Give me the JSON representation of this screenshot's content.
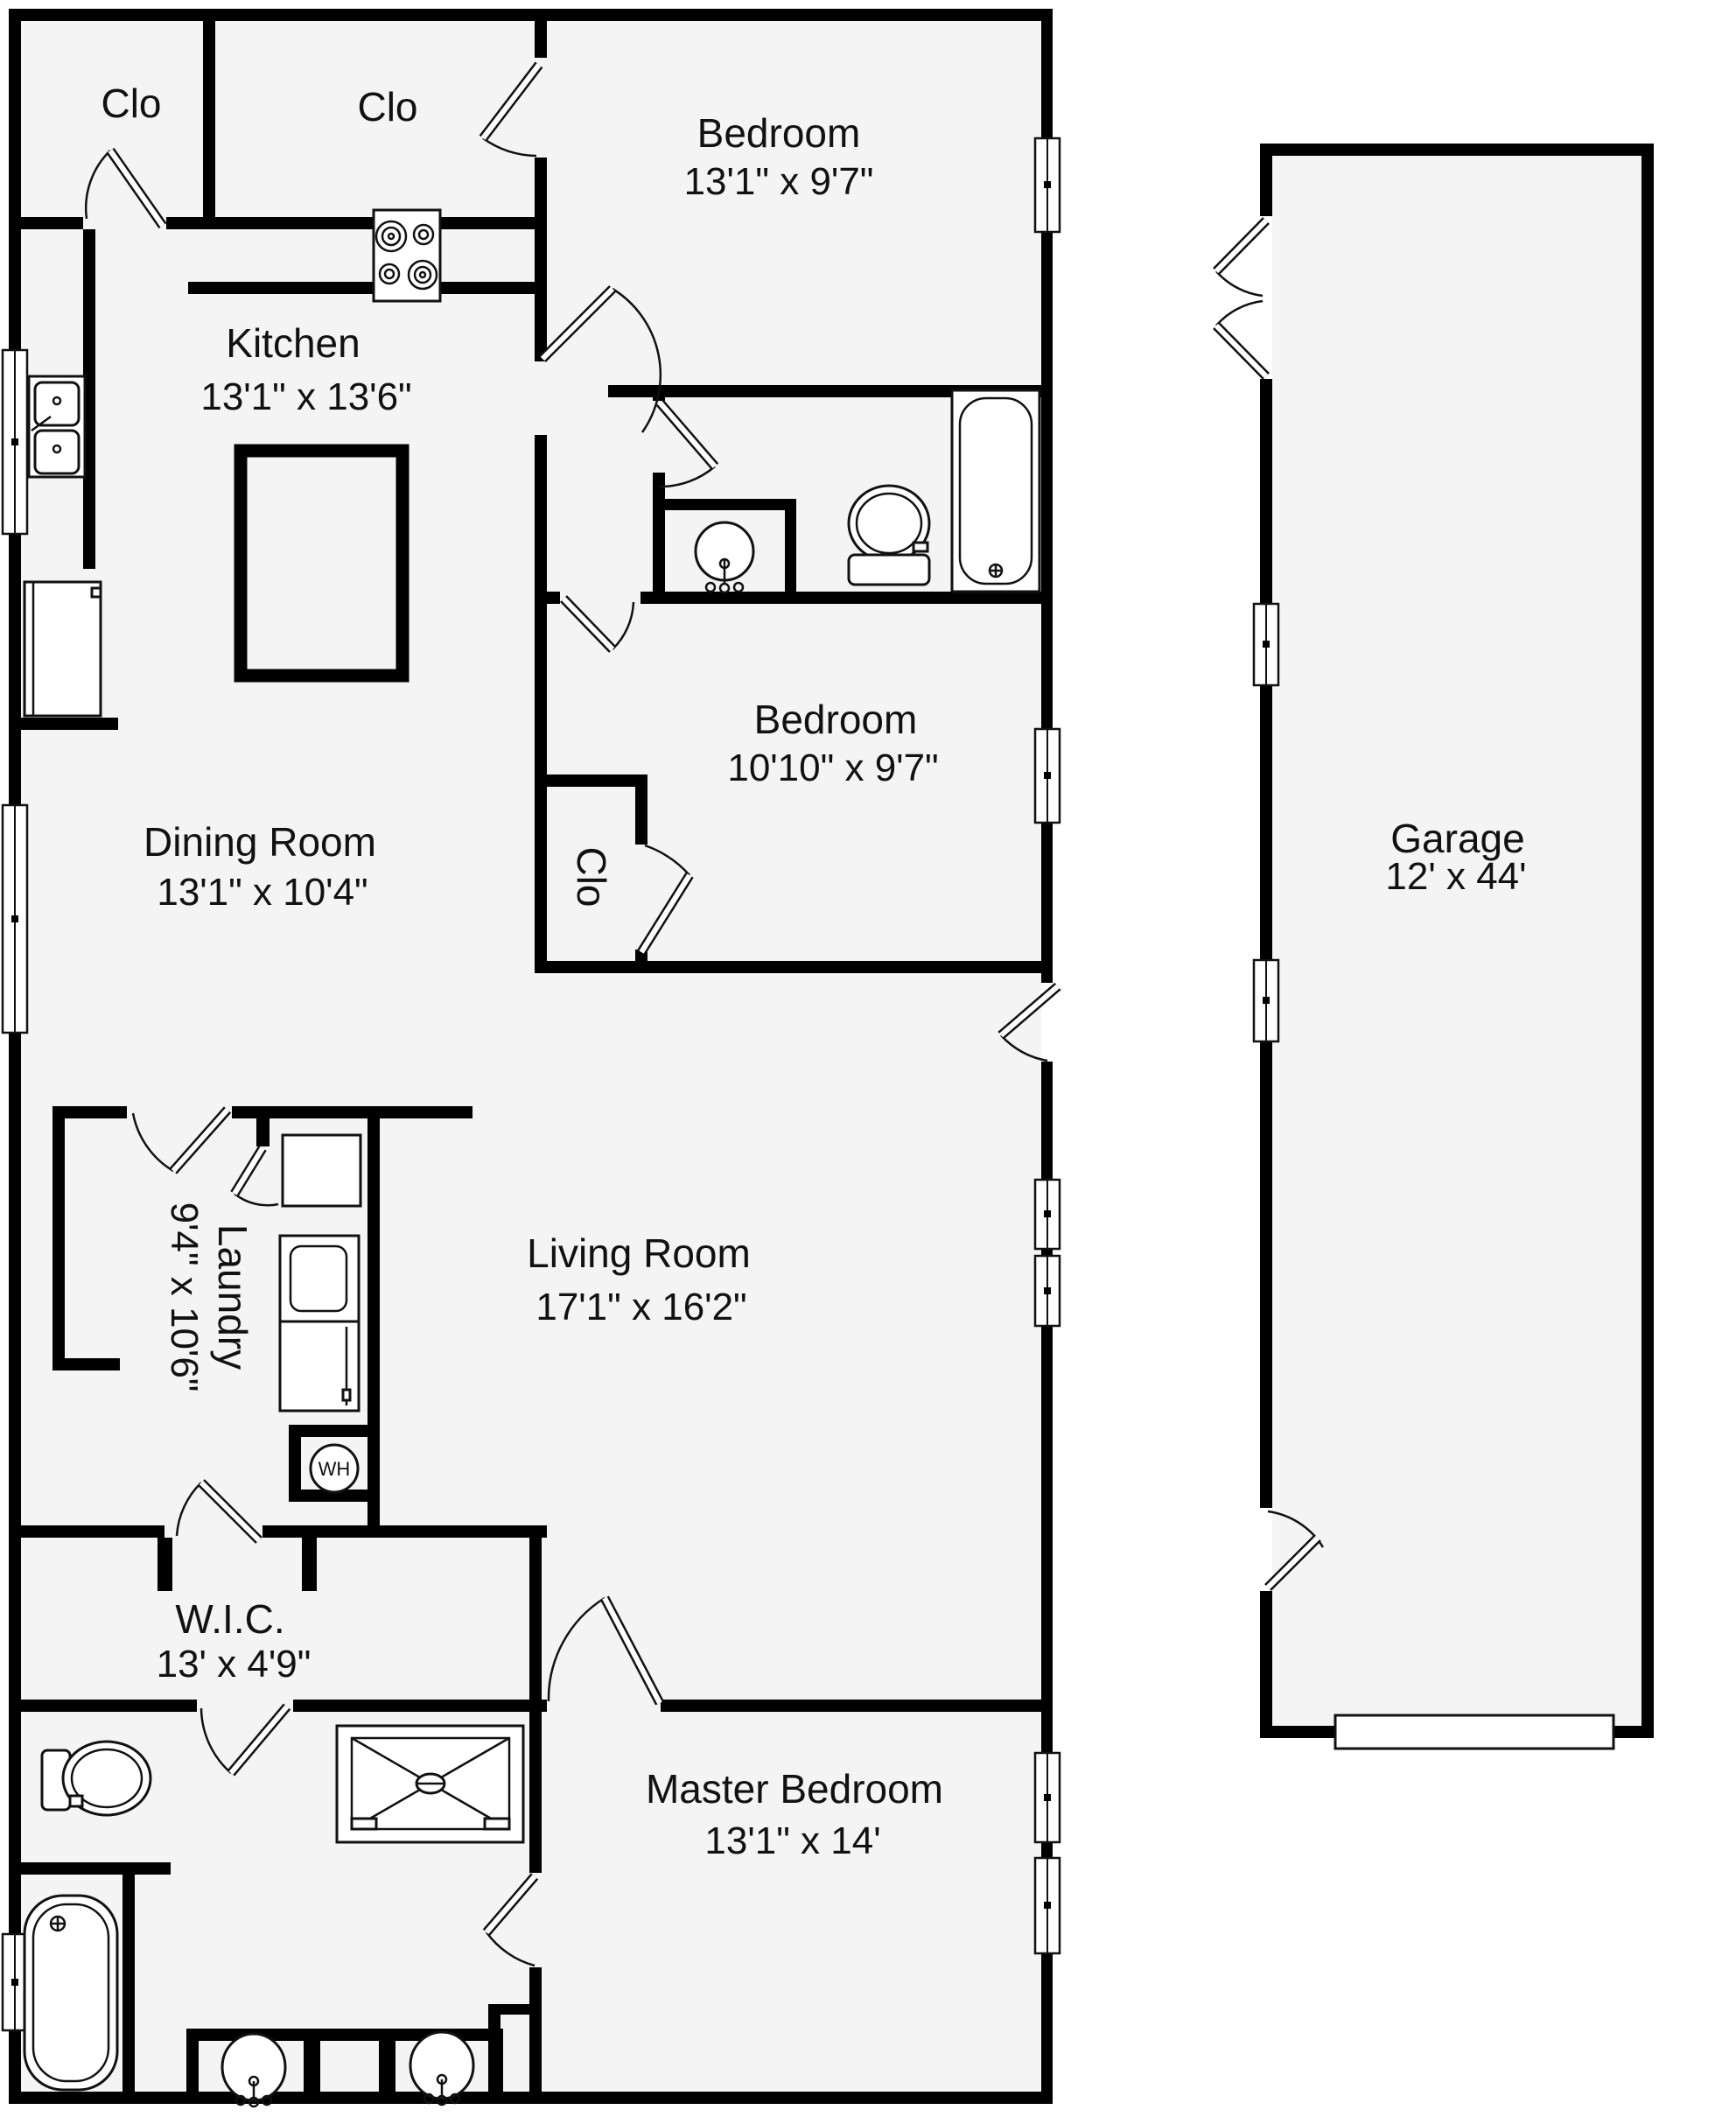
{
  "document": {
    "type": "floor-plan",
    "buildings": [
      "main-house",
      "garage"
    ]
  },
  "colors": {
    "wall": "#000000",
    "floor": "#f4f4f4",
    "background": "#ffffff",
    "text": "#111111"
  },
  "rooms": [
    {
      "name": "Clo",
      "dims": ""
    },
    {
      "name": "Clo",
      "dims": ""
    },
    {
      "name": "Bedroom",
      "dims": "13'1\" x 9'7\""
    },
    {
      "name": "Kitchen",
      "dims": "13'1\" x 13'6\""
    },
    {
      "name": "Bedroom",
      "dims": "10'10\" x 9'7\""
    },
    {
      "name": "Dining Room",
      "dims": "13'1\" x 10'4\""
    },
    {
      "name": "Clo",
      "dims": ""
    },
    {
      "name": "Garage",
      "dims": "12' x 44'"
    },
    {
      "name": "Laundry",
      "dims": "9'4\" x 10'6\""
    },
    {
      "name": "Living Room",
      "dims": "17'1\" x 16'2\""
    },
    {
      "name": "W.I.C.",
      "dims": "13' x 4'9\""
    },
    {
      "name": "Master Bedroom",
      "dims": "13'1\" x 14'"
    }
  ],
  "water_heater": {
    "label": "WH"
  },
  "fixtures": [
    "stove-cooktop",
    "kitchen-double-sink",
    "kitchen-island",
    "refrigerator",
    "bathroom-vanity-sink",
    "toilet",
    "bathtub",
    "laundry-closet",
    "stacked-washer-dryer",
    "water-heater",
    "shower",
    "master-toilet",
    "master-bathtub",
    "double-vanity-sinks",
    "garage-door-panel"
  ]
}
